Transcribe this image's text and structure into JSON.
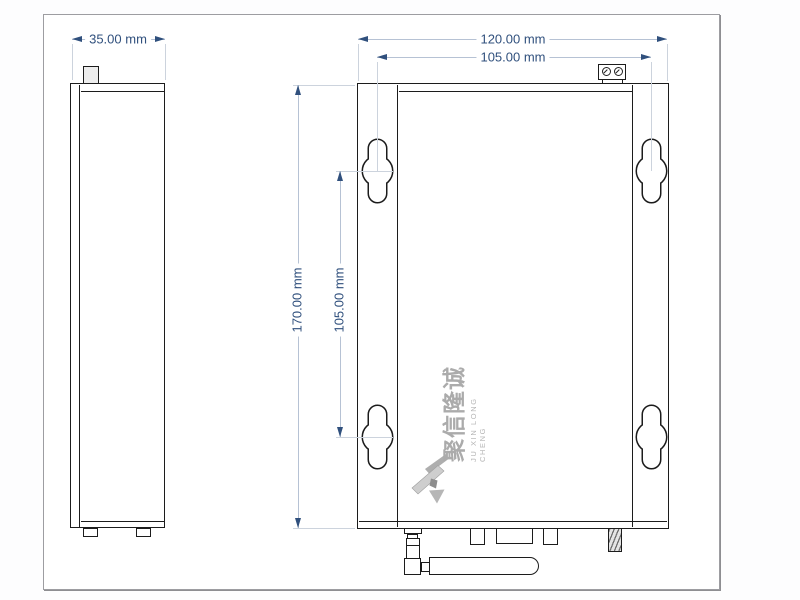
{
  "document": {
    "type": "mechanical-dimension-drawing",
    "views": [
      "side-view",
      "front-view"
    ]
  },
  "dimensions": {
    "side_width": "35.00 mm",
    "front_width": "120.00 mm",
    "hole_spacing_horizontal": "105.00 mm",
    "front_height": "170.00 mm",
    "hole_spacing_vertical": "105.00 mm"
  },
  "watermark": {
    "name_cn": "聚信隆诚",
    "name_en": "JU XIN LONG CHENG"
  },
  "colors": {
    "dimension_text": "#30507d",
    "dimension_line": "#b6c2d4",
    "extension_line": "#ccd3dd",
    "object_outline": "#1c1c1c",
    "watermark_gray": "#ababab"
  }
}
